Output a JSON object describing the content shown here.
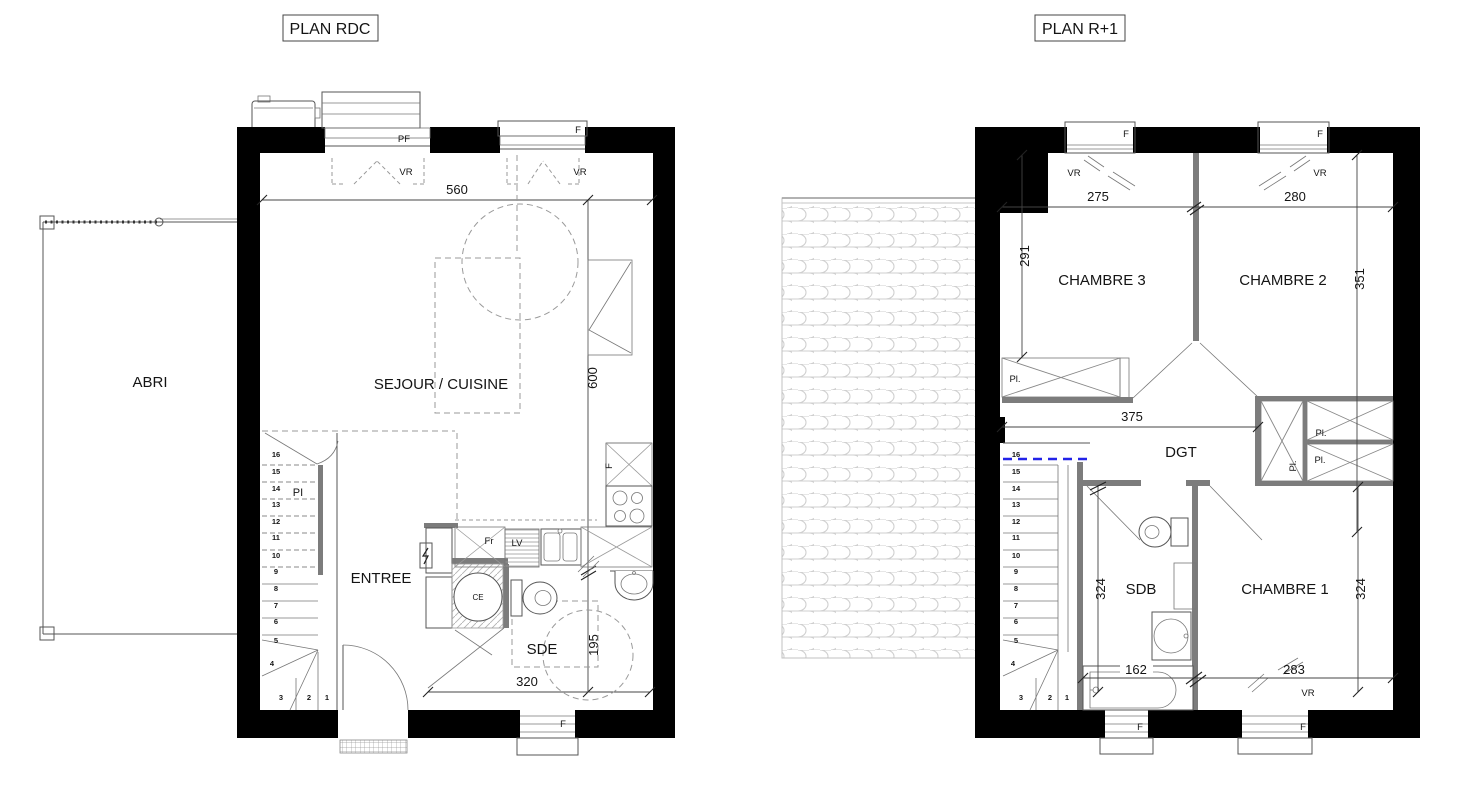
{
  "shared": {
    "stair_numbers": [
      "1",
      "2",
      "3",
      "4",
      "5",
      "6",
      "7",
      "8",
      "9",
      "10",
      "11",
      "12",
      "13",
      "14",
      "15",
      "16"
    ],
    "labels": {
      "f": "F",
      "pf": "PF",
      "vr": "VR",
      "fr": "Fr",
      "lv": "LV",
      "ce": "CE",
      "pi": "PI",
      "pl": "Pl."
    },
    "colors": {
      "wall": "#000000",
      "partition": "#7c7c7c",
      "roof_tile": "#cfcfcf",
      "trap_line": "#2222e8"
    }
  },
  "plan_rdc": {
    "title": "PLAN RDC",
    "rooms": {
      "abri": "ABRI",
      "sejour": "SEJOUR / CUISINE",
      "entree": "ENTREE",
      "sde": "SDE"
    },
    "dims": {
      "top": "560",
      "h_upper": "600",
      "h_lower": "195",
      "sde_w": "320"
    }
  },
  "plan_r1": {
    "title": "PLAN R+1",
    "rooms": {
      "ch1": "CHAMBRE 1",
      "ch2": "CHAMBRE 2",
      "ch3": "CHAMBRE 3",
      "dgt": "DGT",
      "sdb": "SDB"
    },
    "dims": {
      "ch3_w": "275",
      "ch2_w": "280",
      "ch3_h": "291",
      "ch2_h": "351",
      "dgt_w": "375",
      "sdb_h": "324",
      "ch1_h": "324",
      "bath_w": "162",
      "ch1_w": "283"
    }
  }
}
